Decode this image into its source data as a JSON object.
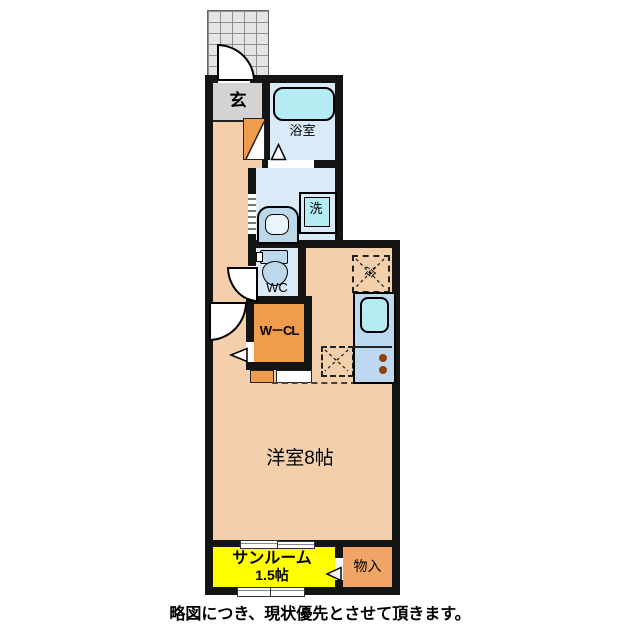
{
  "floorplan": {
    "labels": {
      "entrance": "玄",
      "bathroom": "浴室",
      "washer": "洗",
      "wc": "WC",
      "closet": "W－CL",
      "fridge": "冷",
      "main_room": "洋室8帖",
      "sunroom_name": "サンルーム",
      "sunroom_size": "1.5帖",
      "storage": "物入"
    },
    "caption": "略図につき、現状優先とさせて頂きます。",
    "colors": {
      "wall": "#141414",
      "room_peach": "#f3cfab",
      "entrance_gray": "#d3d3d3",
      "wet_blue": "#dbeaf7",
      "fixture_teal": "#b5ebf3",
      "fixture_blue": "#bcd9ec",
      "closet_orange": "#ef9c4d",
      "storage_orange": "#efa566",
      "sunroom_yellow": "#ffff00",
      "counter_blue": "#bcd9ef",
      "burner_brown": "#8f3f10"
    }
  }
}
